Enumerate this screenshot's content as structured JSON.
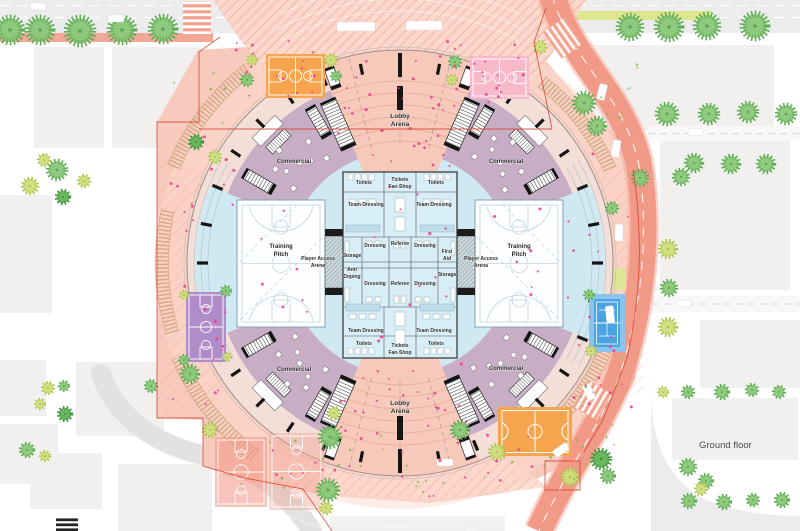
{
  "legend": {
    "floor_label": "Ground floor"
  },
  "arena": {
    "lobby": {
      "line1": "Lobby",
      "line2": "Arena"
    },
    "commercial_label": "Commercial",
    "training_pitch": {
      "line1": "Training",
      "line2": "Pitch"
    },
    "player_access": {
      "line1": "Player Access",
      "line2": "Arena"
    },
    "core": {
      "tickets": {
        "line1": "Tickets",
        "line2": "Fan-Shop"
      },
      "toilets": "Toilets",
      "team_dressing": "Team Dressing",
      "dressing": "Dressing",
      "referee": "Referee",
      "storage": "Storage",
      "anti_doping": {
        "line1": "Anti",
        "line2": "Doping"
      },
      "first_aid": {
        "line1": "First",
        "line2": "Aid"
      }
    }
  },
  "colors": {
    "plaza": "#f8cabd",
    "plaza_light": "#fbd8cd",
    "arena_blue": "#cfe8f1",
    "arena_pale": "#f3ded8",
    "commercial_mauve": "#c8aec5",
    "lobby_pink": "#f7c9bb",
    "court_orange": "#f6a54e",
    "court_pink": "#f8b9cb",
    "court_purple": "#b08cc8",
    "court_blue": "#4aa3e3",
    "tennis_bg": "#8ac4ec",
    "tree_green": "#8bc87a",
    "tree_lime": "#cfe07c",
    "tree_dark": "#63b456",
    "crowd_dot_pink": "#f0418c",
    "crowd_dot_green": "#7ebf4e",
    "boundary_red": "#d9402f",
    "road_salmon": "#f29a88",
    "tan_band": "#cda57c"
  }
}
